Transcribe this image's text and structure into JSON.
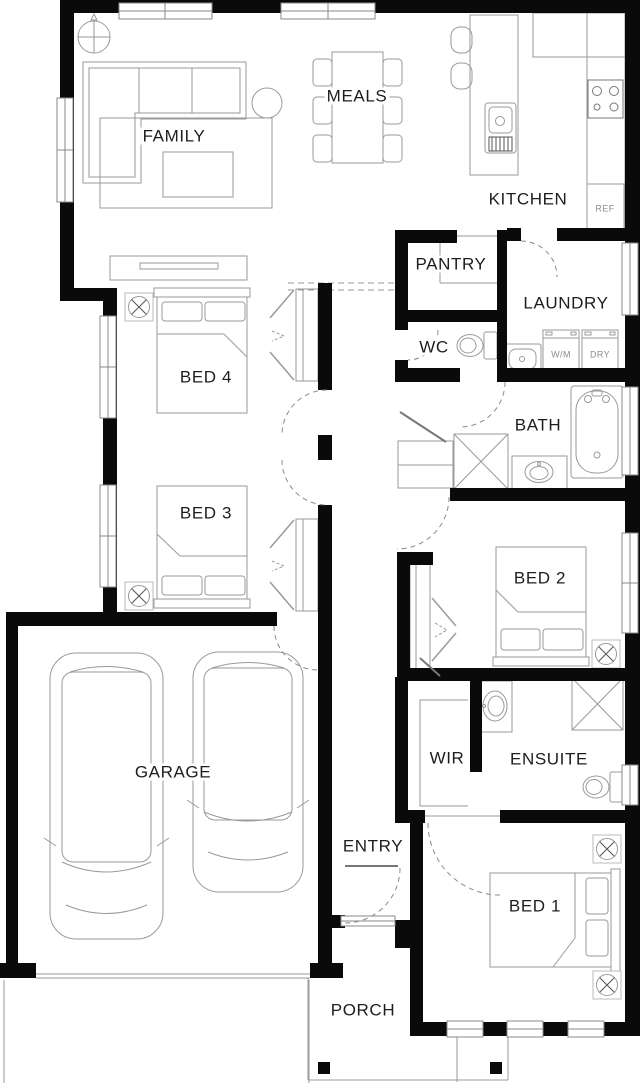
{
  "colors": {
    "wall": "#0a0a0a",
    "furniture_line": "#9a9a9a",
    "label_text": "#1d1d1d"
  },
  "rooms": {
    "family": "FAMILY",
    "meals": "MEALS",
    "kitchen": "KITCHEN",
    "pantry": "PANTRY",
    "laundry": "LAUNDRY",
    "wc": "WC",
    "bed4": "BED 4",
    "bath": "BATH",
    "bed3": "BED 3",
    "bed2": "BED 2",
    "garage": "GARAGE",
    "wir": "WIR",
    "ensuite": "ENSUITE",
    "entry": "ENTRY",
    "bed1": "BED 1",
    "porch": "PORCH"
  },
  "appliances": {
    "fridge": "REF",
    "washer": "W/M",
    "dryer": "DRY"
  }
}
